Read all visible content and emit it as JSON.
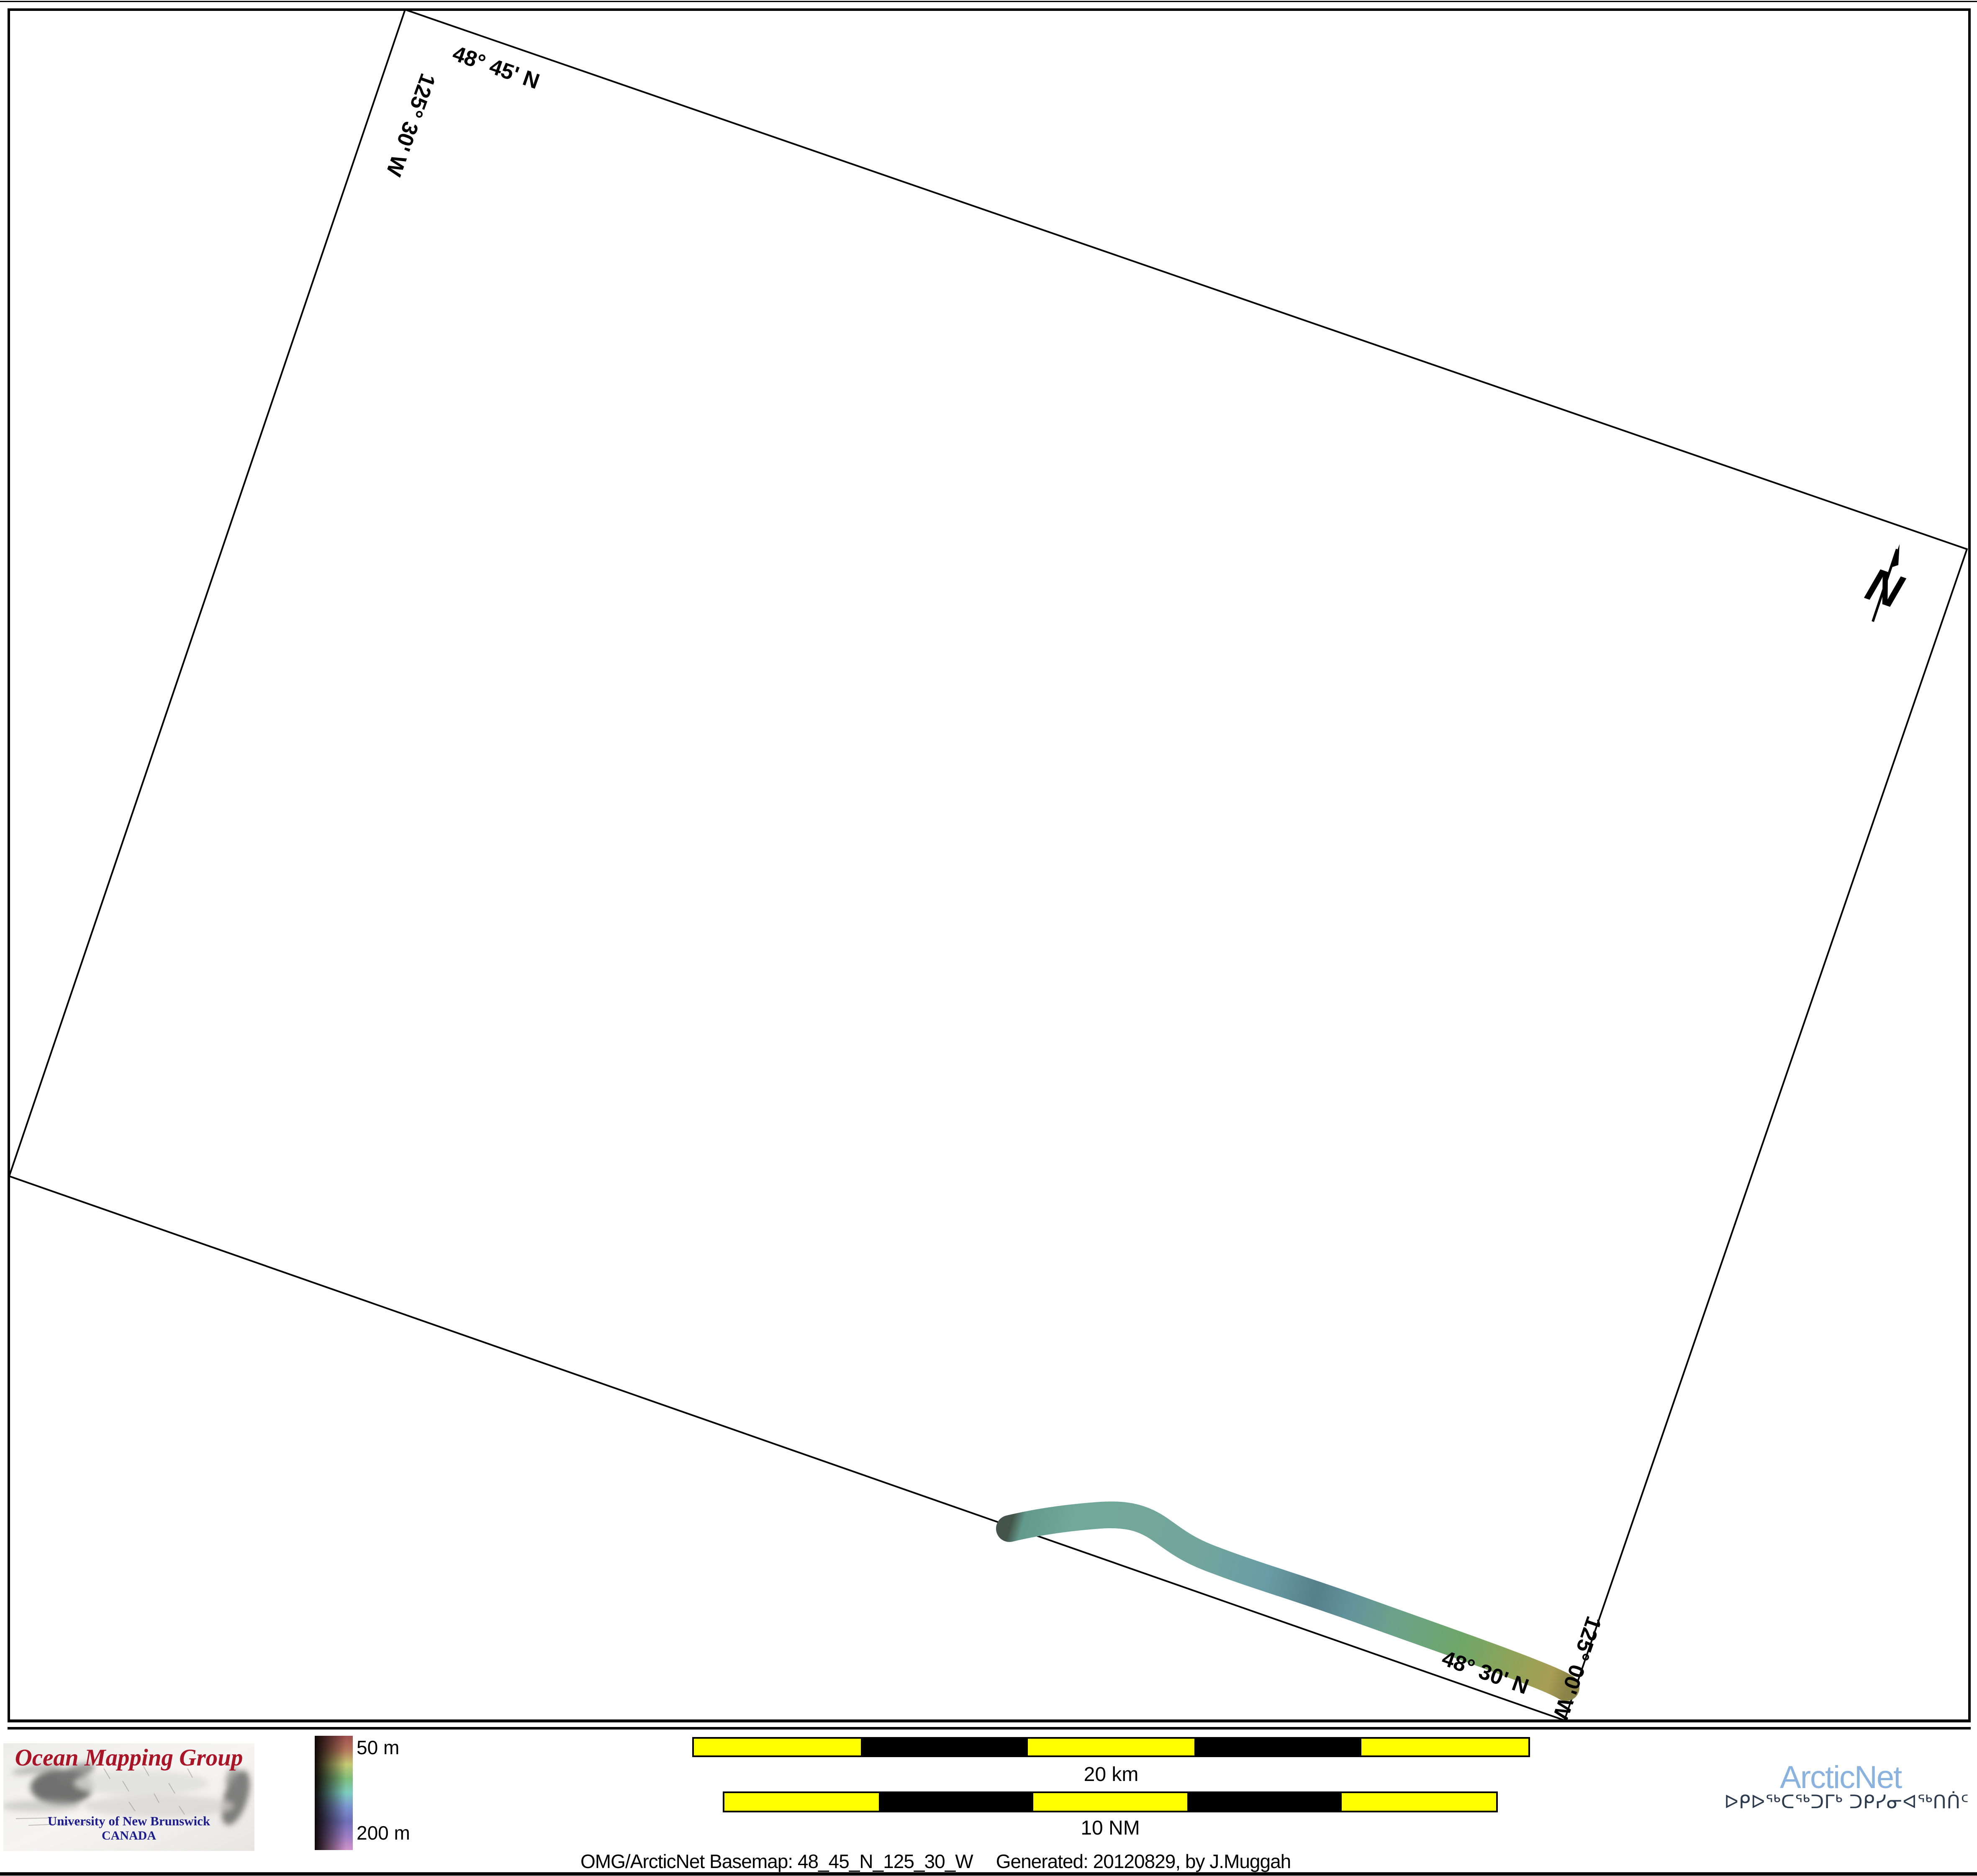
{
  "map": {
    "labels": {
      "top_lat": "48° 45' N",
      "left_lon": "125° 30' W",
      "bottom_lat": "48° 30' N",
      "right_lon": "125° 00' W"
    },
    "north_arrow_label": "N"
  },
  "legend": {
    "top_label": "50 m",
    "bottom_label": "200 m",
    "hue_stops": [
      "#9e4f4f",
      "#b4775c",
      "#c6c973",
      "#7fbd7b",
      "#7ecdc2",
      "#7b93cf",
      "#6f6fb8",
      "#9a7cc4",
      "#d193c9"
    ]
  },
  "scalebars": {
    "km": {
      "label": "20 km"
    },
    "nm": {
      "label": "10 NM"
    },
    "segment_colors": [
      "#ffff00",
      "#000000",
      "#ffff00",
      "#000000",
      "#ffff00"
    ]
  },
  "caption": {
    "part1": "OMG/ArcticNet Basemap: 48_45_N_125_30_W",
    "part2": "Generated: 20120829, by J.Muggah"
  },
  "omg_logo": {
    "title": "Ocean Mapping Group",
    "subtitle": "University of New Brunswick",
    "country": "CANADA",
    "title_color": "#a91526",
    "subtitle_color": "#1d1d8f"
  },
  "arcticnet_logo": {
    "name": "ArcticNet",
    "syllabics": "ᐅᑭᐅᖅᑕᖅᑐᒥᒃ ᑐᑭᓯᓂᐊᖅᑎᑏᑦ",
    "name_color": "#8ab2de",
    "syllabics_color": "#2c3c4e"
  },
  "swath_gradient": [
    {
      "offset": "0%",
      "color": "#44544a"
    },
    {
      "offset": "2%",
      "color": "#62998b"
    },
    {
      "offset": "10%",
      "color": "#71a897"
    },
    {
      "offset": "32%",
      "color": "#72a69c"
    },
    {
      "offset": "45%",
      "color": "#699da6"
    },
    {
      "offset": "54%",
      "color": "#567f8b"
    },
    {
      "offset": "60%",
      "color": "#62929c"
    },
    {
      "offset": "68%",
      "color": "#6ba28b"
    },
    {
      "offset": "80%",
      "color": "#6ea66a"
    },
    {
      "offset": "90%",
      "color": "#8fa458"
    },
    {
      "offset": "97%",
      "color": "#a89d55"
    },
    {
      "offset": "100%",
      "color": "#8a8448"
    }
  ]
}
